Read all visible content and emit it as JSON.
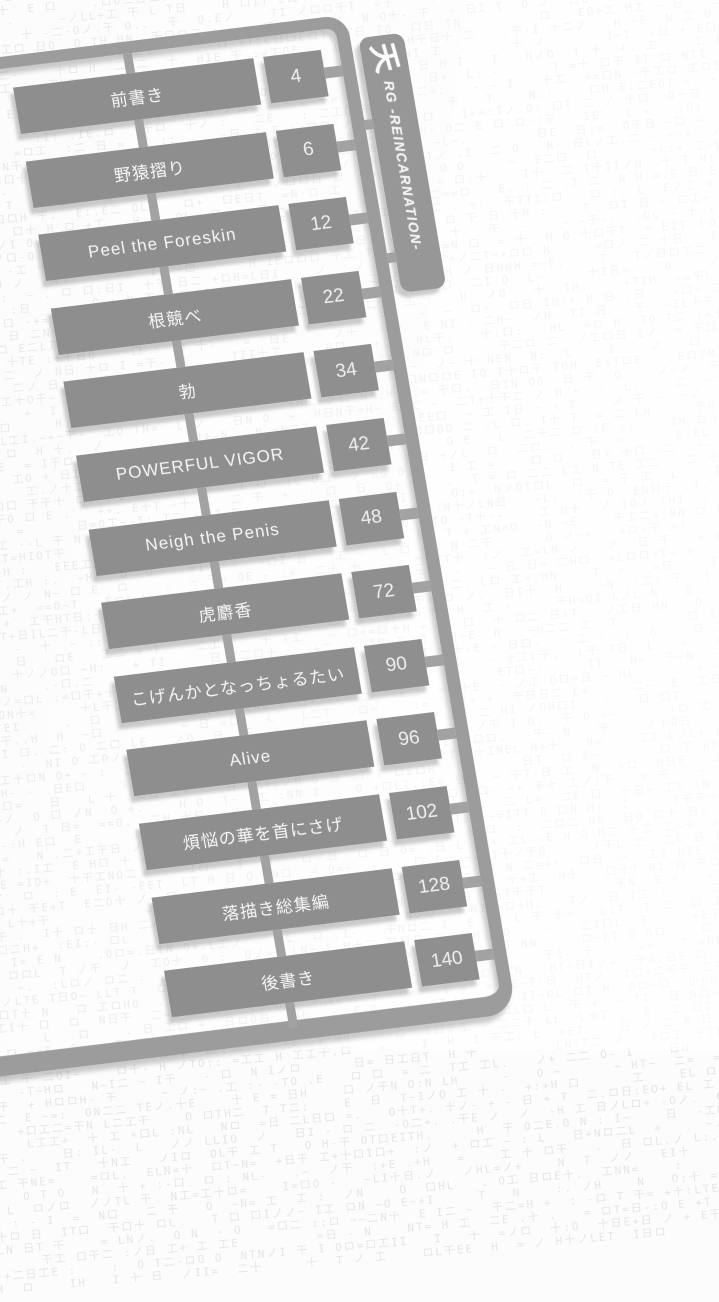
{
  "page": {
    "background_color": "#fcfcfc",
    "texture_color": "#e6e6e6",
    "texture_chars": "HITOLNE日ロノ二十干工口 -=+~:."
  },
  "sprue": {
    "part_color": "#8e8e8e",
    "rail_color": "#9c9c9c",
    "label_bar": {
      "logo_glyph": "天",
      "series_text": "RG -REINCARNATION-"
    },
    "toc": [
      {
        "title": "前書き",
        "page": "4"
      },
      {
        "title": "野猿摺り",
        "page": "6"
      },
      {
        "title": "Peel the Foreskin",
        "page": "12"
      },
      {
        "title": "根競べ",
        "page": "22"
      },
      {
        "title": "勃",
        "page": "34"
      },
      {
        "title": "POWERFUL VIGOR",
        "page": "42"
      },
      {
        "title": "Neigh the Penis",
        "page": "48"
      },
      {
        "title": "虎麝香",
        "page": "72"
      },
      {
        "title": "こげんかとなっちょるたい",
        "page": "90"
      },
      {
        "title": "Alive",
        "page": "96"
      },
      {
        "title": "煩悩の華を首にさげ",
        "page": "102"
      },
      {
        "title": "落描き総集編",
        "page": "128"
      },
      {
        "title": "後書き",
        "page": "140"
      }
    ]
  }
}
